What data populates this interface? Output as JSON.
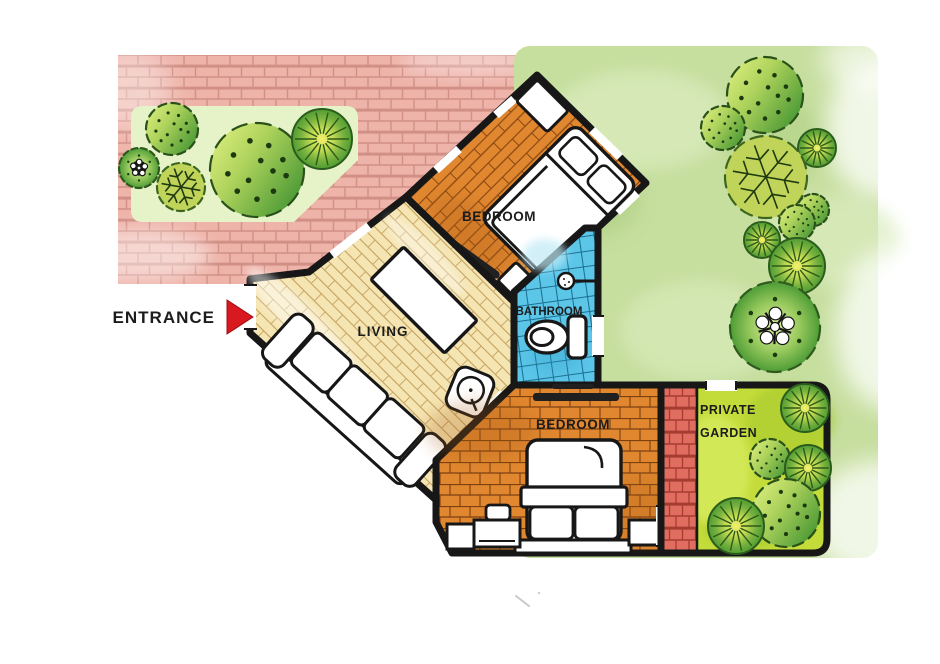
{
  "labels": {
    "entrance": "ENTRANCE",
    "living": "LIVING",
    "bedroom_top": "BEDROOM",
    "bedroom_bottom": "BEDROOM",
    "bathroom": "BATHROOM",
    "private_garden_line1": "PRIVATE",
    "private_garden_line2": "GARDEN"
  },
  "palette": {
    "entrance_red": "#d8191f",
    "brick_path_pink": "#eeb4aa",
    "garden_wall_red": "#e06d60",
    "wood_orange": "#e0872f",
    "wood_cream": "#f5e5b2",
    "bathroom_tile_blue": "#5cc6e9",
    "lawn_green": "#c6de9e",
    "private_garden_green": "#c3dc3a",
    "wall_black": "#171717"
  },
  "trees": [
    {
      "type": "bush",
      "cx": 172,
      "cy": 129,
      "r": 26
    },
    {
      "type": "flower",
      "cx": 139,
      "cy": 168,
      "r": 20
    },
    {
      "type": "vein",
      "cx": 181,
      "cy": 187,
      "r": 24
    },
    {
      "type": "bush",
      "cx": 257,
      "cy": 170,
      "r": 47
    },
    {
      "type": "radial",
      "cx": 322,
      "cy": 139,
      "r": 30
    },
    {
      "type": "bush",
      "cx": 765,
      "cy": 95,
      "r": 38
    },
    {
      "type": "bush",
      "cx": 723,
      "cy": 128,
      "r": 22
    },
    {
      "type": "radial",
      "cx": 817,
      "cy": 148,
      "r": 19
    },
    {
      "type": "vein",
      "cx": 766,
      "cy": 177,
      "r": 41
    },
    {
      "type": "bush",
      "cx": 813,
      "cy": 210,
      "r": 16
    },
    {
      "type": "bush",
      "cx": 797,
      "cy": 223,
      "r": 18
    },
    {
      "type": "radial",
      "cx": 762,
      "cy": 240,
      "r": 18
    },
    {
      "type": "radial",
      "cx": 797,
      "cy": 266,
      "r": 28
    },
    {
      "type": "flower",
      "cx": 775,
      "cy": 327,
      "r": 45
    },
    {
      "type": "radial",
      "cx": 805,
      "cy": 408,
      "r": 24
    },
    {
      "type": "bush",
      "cx": 770,
      "cy": 459,
      "r": 20
    },
    {
      "type": "radial",
      "cx": 808,
      "cy": 468,
      "r": 23
    },
    {
      "type": "bush",
      "cx": 786,
      "cy": 513,
      "r": 34
    },
    {
      "type": "radial",
      "cx": 736,
      "cy": 526,
      "r": 28
    }
  ]
}
